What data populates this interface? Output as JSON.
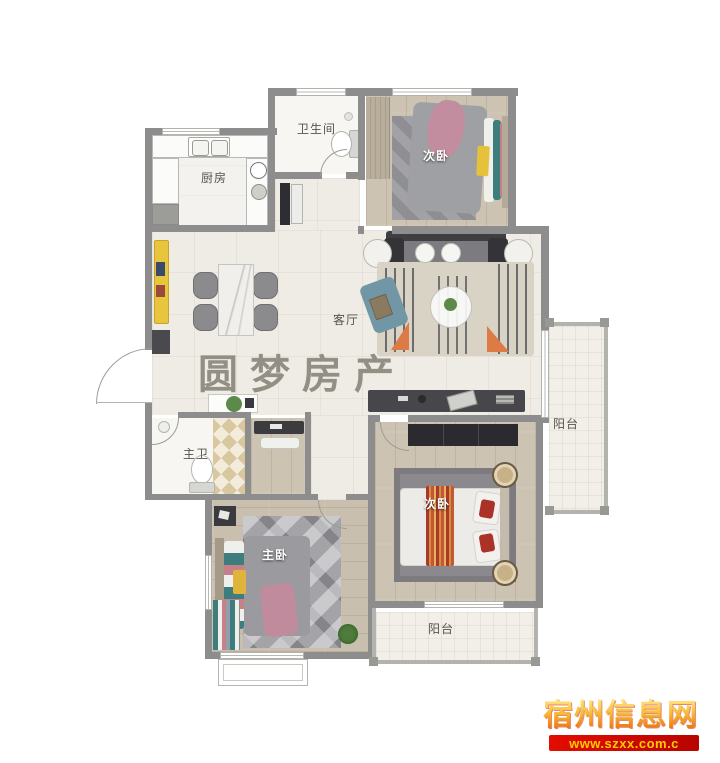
{
  "page": {
    "type": "apartment floor plan",
    "canvas_width": 720,
    "canvas_height": 763
  },
  "rooms": {
    "kitchen": {
      "label": "厨房"
    },
    "bathroom": {
      "label": "卫生间"
    },
    "bedroom_top": {
      "label": "次卧"
    },
    "living_room": {
      "label": "客厅"
    },
    "master_bathroom": {
      "label": "主卫"
    },
    "master_bedroom": {
      "label": "主卧"
    },
    "bedroom_bottom": {
      "label": "次卧"
    },
    "balcony_right": {
      "label": "阳台"
    },
    "balcony_bottom": {
      "label": "阳台"
    }
  },
  "watermark": {
    "text": "圆梦房产",
    "color": "#7e7a6f"
  },
  "site_badge": {
    "name": "宿州信息网",
    "url": "www.szxx.com.c",
    "name_color_top": "#ffe98e",
    "name_color_bottom": "#e85d04",
    "banner_color": "#e30d00",
    "url_color": "#ffcc00"
  },
  "palette": {
    "wall": "#8d8d8d",
    "tile_floor": "#efece5",
    "wood_floor": "#cdc3b2",
    "bathroom_floor": "#f7f6f3",
    "balcony_floor": "#f1efe7",
    "sofa": "#7b7b80",
    "living_rug": "#d9d3c6",
    "gray_rug": "#8b898e",
    "accent_orange": "#dd7a45",
    "accent_teal": "#3e7d7d",
    "accent_pink": "#c38da0",
    "accent_yellow": "#e6c23c",
    "bed_white": "#ecebe7",
    "wardrobe_dark": "#2b2b2f"
  }
}
